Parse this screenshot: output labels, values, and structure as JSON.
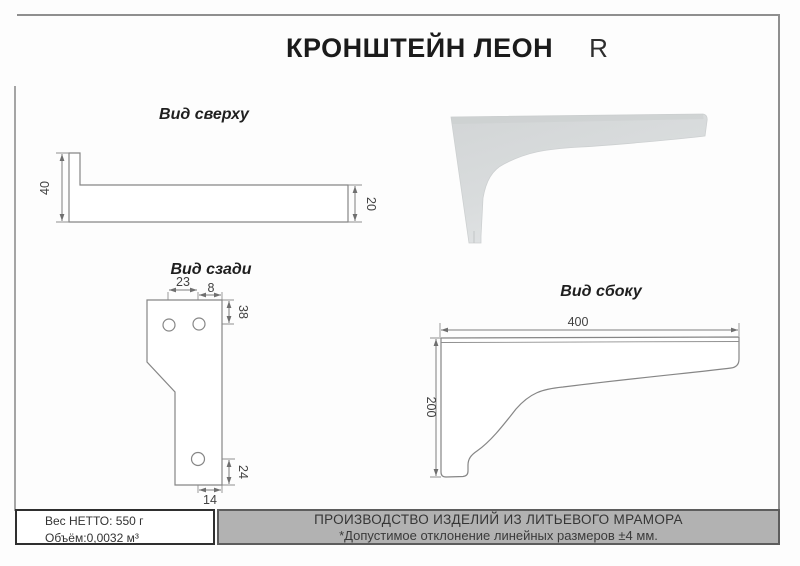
{
  "title": {
    "main": "КРОНШТЕЙН ЛЕОН",
    "variant": "R"
  },
  "views": {
    "top": {
      "label": "Вид сверху",
      "dim_height_left": "40",
      "dim_depth_right": "20"
    },
    "back": {
      "label": "Вид сзади",
      "dim_hole_spacing": "23",
      "dim_hole_to_edge": "8",
      "dim_top_to_hole": "38",
      "dim_hole_to_bottom": "24",
      "dim_bottom_width": "14"
    },
    "side": {
      "label": "Вид сбоку",
      "dim_length": "400",
      "dim_height": "200"
    }
  },
  "footer": {
    "weight_label": "Вес НЕТТО: 550 г",
    "volume_label": "Объём:0,0032 м³",
    "production_line1": "ПРОИЗВОДСТВО ИЗДЕЛИЙ ИЗ ЛИТЬЕВОГО МРАМОРА",
    "tolerance_line2": "*Допустимое отклонение линейных размеров ±4 мм."
  },
  "colors": {
    "drawing_line": "#868686",
    "dimension_line": "#7d7d7d",
    "footer_gray": "#b2b2b2",
    "render_fill": "#d7dadb",
    "frame": "#8f8f8f"
  }
}
